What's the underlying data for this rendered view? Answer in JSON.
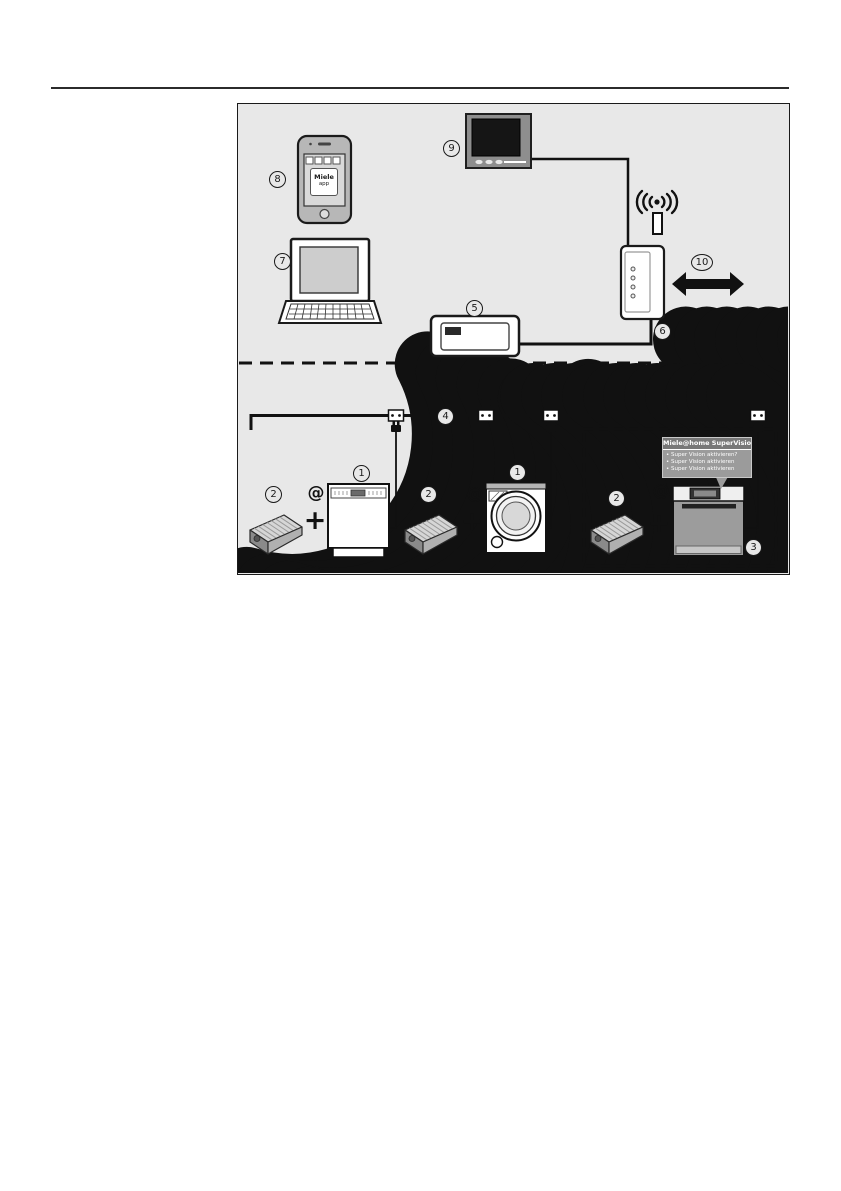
{
  "page": {
    "type": "appliance manual illustration page"
  },
  "diagram": {
    "colors": {
      "background": "#e8e8e8",
      "line": "#1a1a1a",
      "bubble_header": "#787878",
      "bubble_body": "#9b9b9b"
    },
    "labels": {
      "appliance_dishwasher": "1",
      "appliance_washer": "1",
      "module_a": "2",
      "module_b": "2",
      "module_c": "2",
      "supervision_appliance": "3",
      "bus_cable": "4",
      "gateway": "5",
      "router": "6",
      "laptop": "7",
      "smartphone": "8",
      "tv": "9",
      "internet": "10"
    },
    "phone_app": {
      "brand": "Miele",
      "sub": "app"
    },
    "bubble": {
      "title": "Miele@home SuperVision",
      "lines": [
        "• Super Vision aktivieren?",
        "• Super Vision aktivieren",
        "• Super Vision aktivieren"
      ]
    },
    "symbols": {
      "at": "@",
      "plus": "+"
    }
  }
}
